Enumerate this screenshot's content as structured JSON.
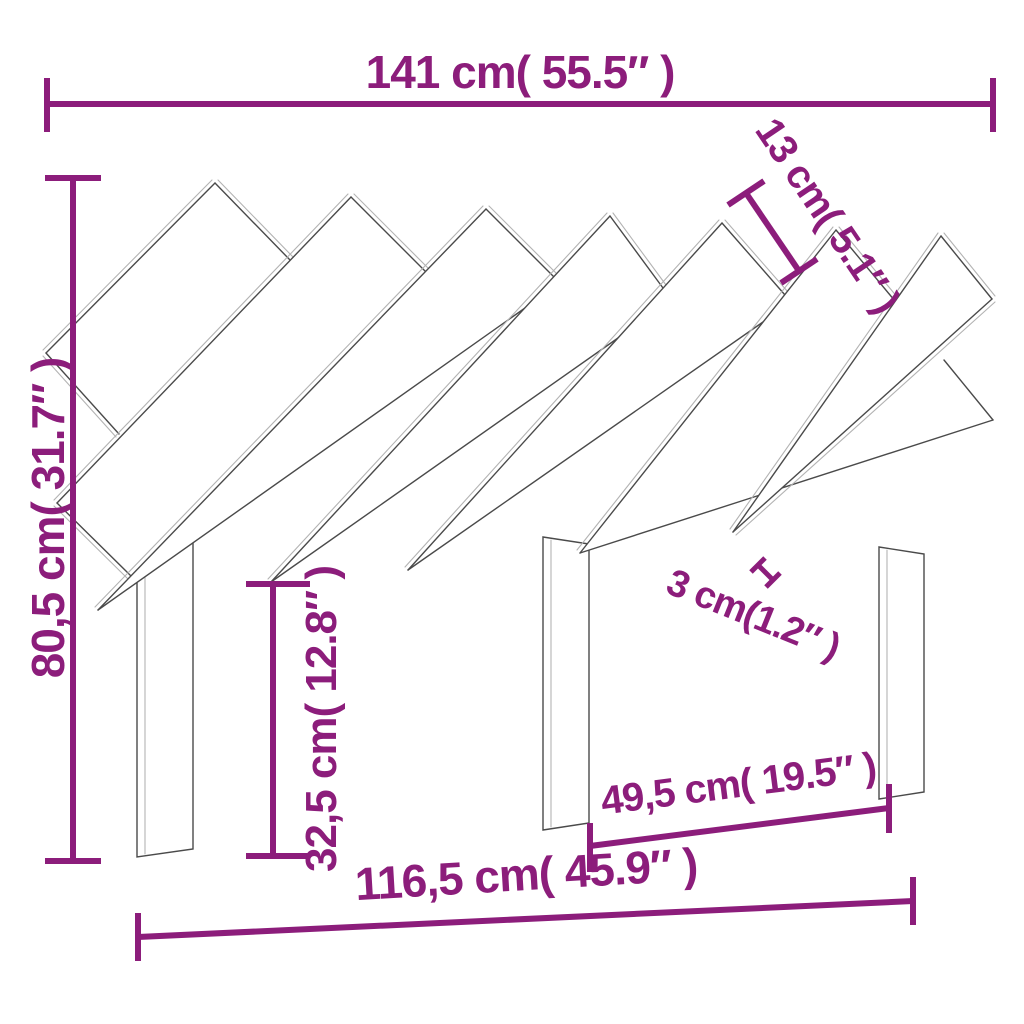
{
  "page": {
    "title": "Headboard dimension diagram",
    "background": "#ffffff"
  },
  "diagram": {
    "product": "Wooden headboard with seven diagonal slats and three legs",
    "style": {
      "accent_color": "#8C1D7B",
      "outline_color": "#4a4a4a",
      "thickness_edge_color": "#b3b3b3",
      "face_color": "#ffffff"
    },
    "annotations": {
      "total_width": "141 cm( 55.5″ )",
      "slat_width": "13 cm( 5.1″ )",
      "total_height": "80,5 cm( 31.7″ )",
      "board_thickness": "3 cm(1.2″ )",
      "leg_height": "32,5 cm( 12.8″ )",
      "leg_spacing": "49,5 cm( 19.5″ )",
      "lower_width": "116,5 cm( 45.9″ )"
    }
  }
}
